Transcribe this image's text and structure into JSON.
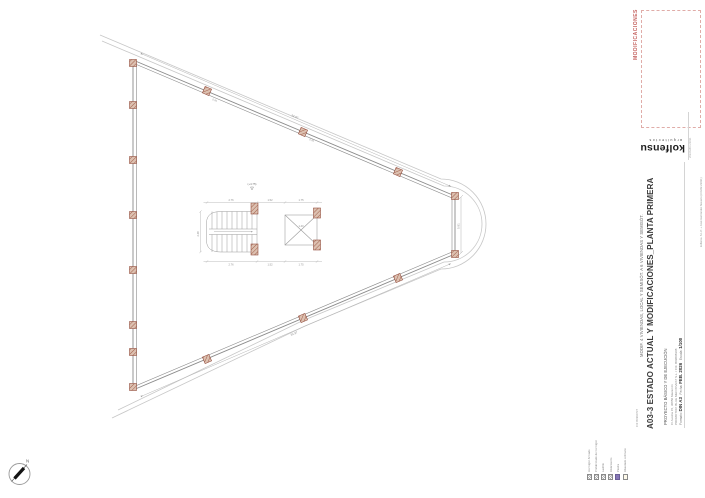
{
  "modifications_box": {
    "label": "MODIFICACIONES",
    "text_color": "#c4625f",
    "border_color": "#e0aca8"
  },
  "logo": {
    "wordmark": "kolfensu",
    "tagline": "arquitectos",
    "registration": "2022AM03 23031"
  },
  "title_block": {
    "project_line": "MODIF. 4 VIVIENDAS, LOCAL Y SEMISÓT. A 6 VIVIENDAS Y SEMISÓT.",
    "sheet_title": "A03-3  ESTADO ACTUAL Y MODIFICACIONES_PLANTA PRIMERA",
    "phase": "PROYECTO BÁSICO Y DE EJECUCIÓN",
    "address": "C/ Austria 15, 30850 Mazarrón",
    "promoter": "PROMOTOR: BLUE MED INVEST S.L. / CIF. B09808308",
    "format_label": "Formato:",
    "format_value": "DIN A3",
    "date_label": "Fecha:",
    "date_value": "FEB. 2026",
    "scale_label": "Escala:",
    "scale_value": "1/100",
    "cif": "CIF B0990737",
    "credits": "kolfensu S.L.P. + José Hernández Navarro (COAM 23031)"
  },
  "legend": {
    "items": [
      {
        "label": "Hormigón Armado",
        "swatch": "hatch"
      },
      {
        "label": "Prefabricado de hormigón",
        "swatch": "hatch"
      },
      {
        "label": "Ladrillo",
        "swatch": "hatch"
      },
      {
        "label": "Aislamiento",
        "swatch": "hatch"
      },
      {
        "label": "Piedra",
        "swatch": "#8677b5"
      },
      {
        "label": "Alveolado ordinario",
        "swatch": "#fdf9ea"
      }
    ]
  },
  "compass": {
    "north_label": "N"
  },
  "plan": {
    "level_mark": "(+4.75)",
    "dims": {
      "stair_width": "2.76",
      "gap": "1.52",
      "shaft_width": "1.75",
      "wall": "0.30",
      "stair_height": "2.48",
      "tip_chord": "5.81",
      "edge_top": "34.97",
      "edge_bottom": "34.97",
      "shaft_inner": "1.40"
    }
  }
}
